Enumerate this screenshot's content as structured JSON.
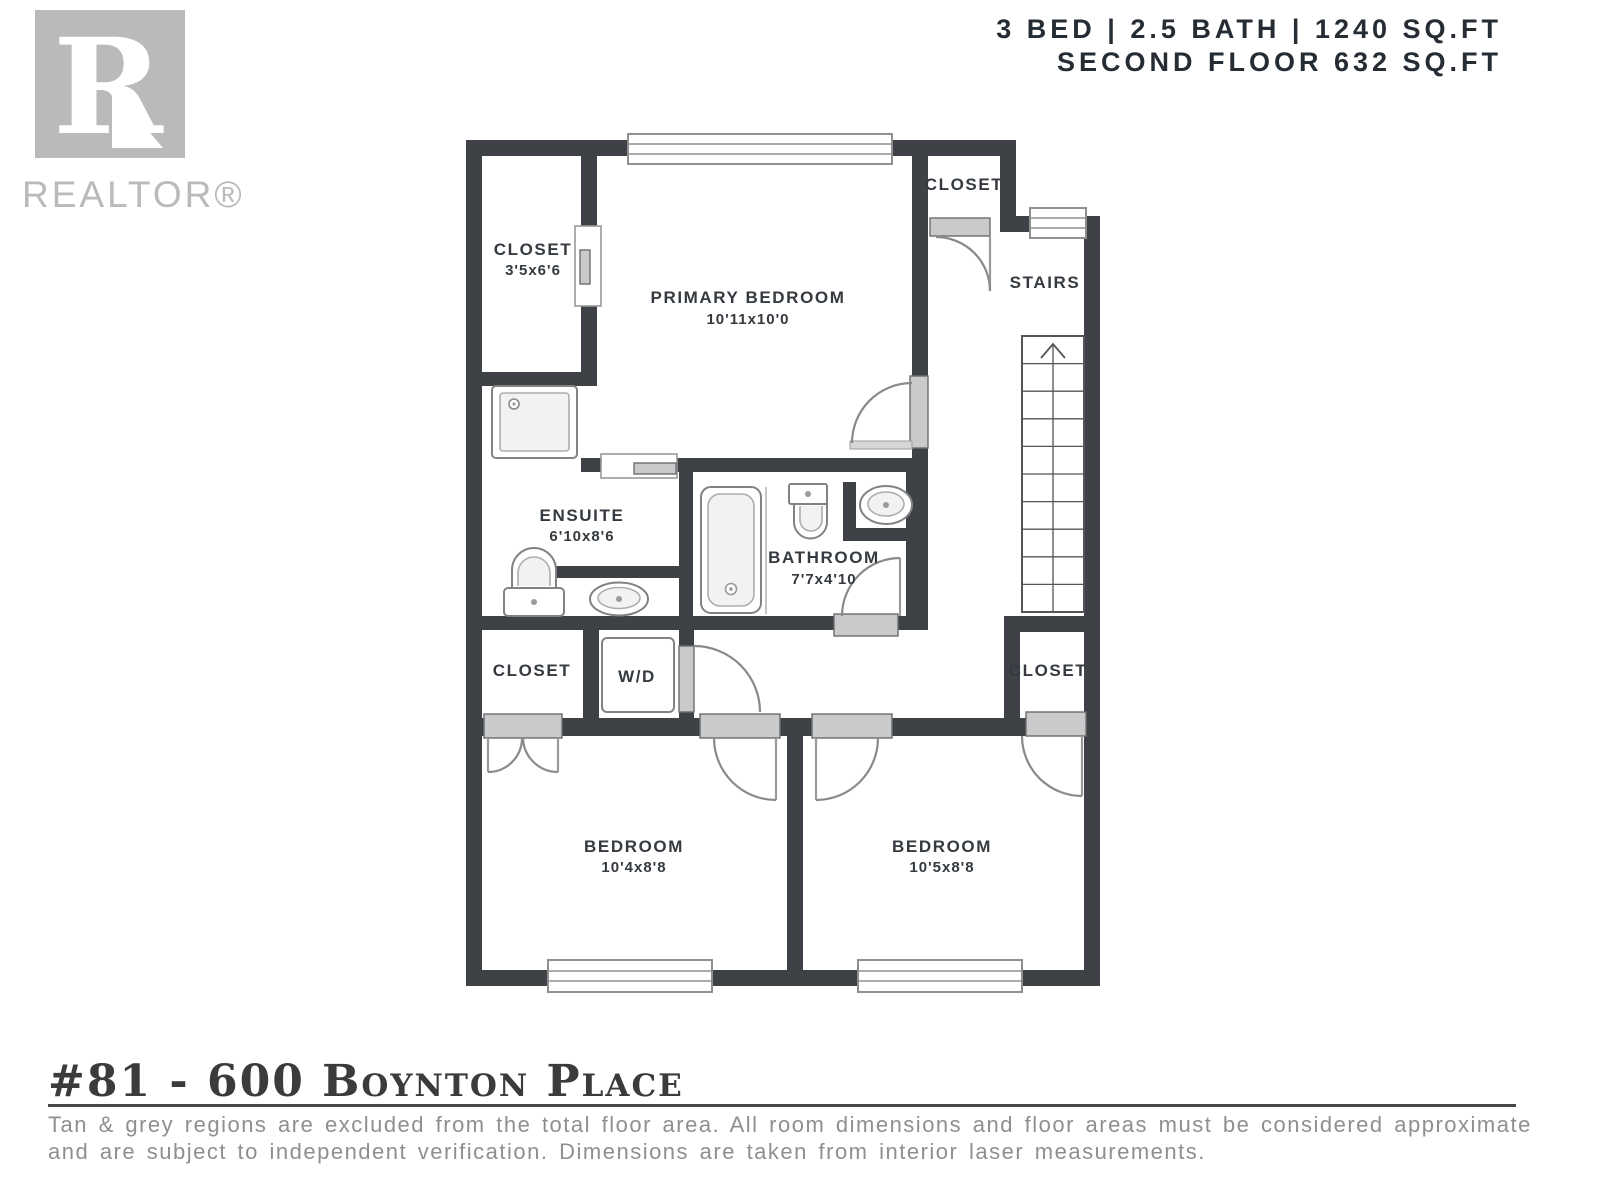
{
  "header": {
    "line1": "3 BED | 2.5 BATH | 1240 SQ.FT",
    "line2": "SECOND FLOOR 632 SQ.FT"
  },
  "logo": {
    "letter": "R",
    "wordmark": "REALTOR®"
  },
  "rooms": {
    "closet_upper_left": {
      "name": "CLOSET",
      "dims": "3'5x6'6"
    },
    "primary_bedroom": {
      "name": "PRIMARY BEDROOM",
      "dims": "10'11x10'0"
    },
    "closet_upper_right": {
      "name": "CLOSET"
    },
    "stairs": {
      "name": "STAIRS"
    },
    "ensuite": {
      "name": "ENSUITE",
      "dims": "6'10x8'6"
    },
    "bathroom": {
      "name": "BATHROOM",
      "dims": "7'7x4'10"
    },
    "closet_mid_left": {
      "name": "CLOSET"
    },
    "laundry": {
      "name": "W/D"
    },
    "closet_mid_right": {
      "name": "CLOSET"
    },
    "bedroom_left": {
      "name": "BEDROOM",
      "dims": "10'4x8'8"
    },
    "bedroom_right": {
      "name": "BEDROOM",
      "dims": "10'5x8'8"
    }
  },
  "footer": {
    "title": "#81 - 600 Boynton Place",
    "disclaimer_line1": "Tan & grey regions are excluded from the total floor area. All room dimensions and floor areas must be considered approximate",
    "disclaimer_line2": "and are subject to independent verification. Dimensions are taken from interior laser measurements."
  },
  "colors": {
    "wall": "#3e4247",
    "threshold": "#c9cacb",
    "logo": "#b9babc",
    "label": "#343a3f",
    "header": "#262c34",
    "disclaimer": "#8f8f8f",
    "title": "#3b3b3b"
  }
}
